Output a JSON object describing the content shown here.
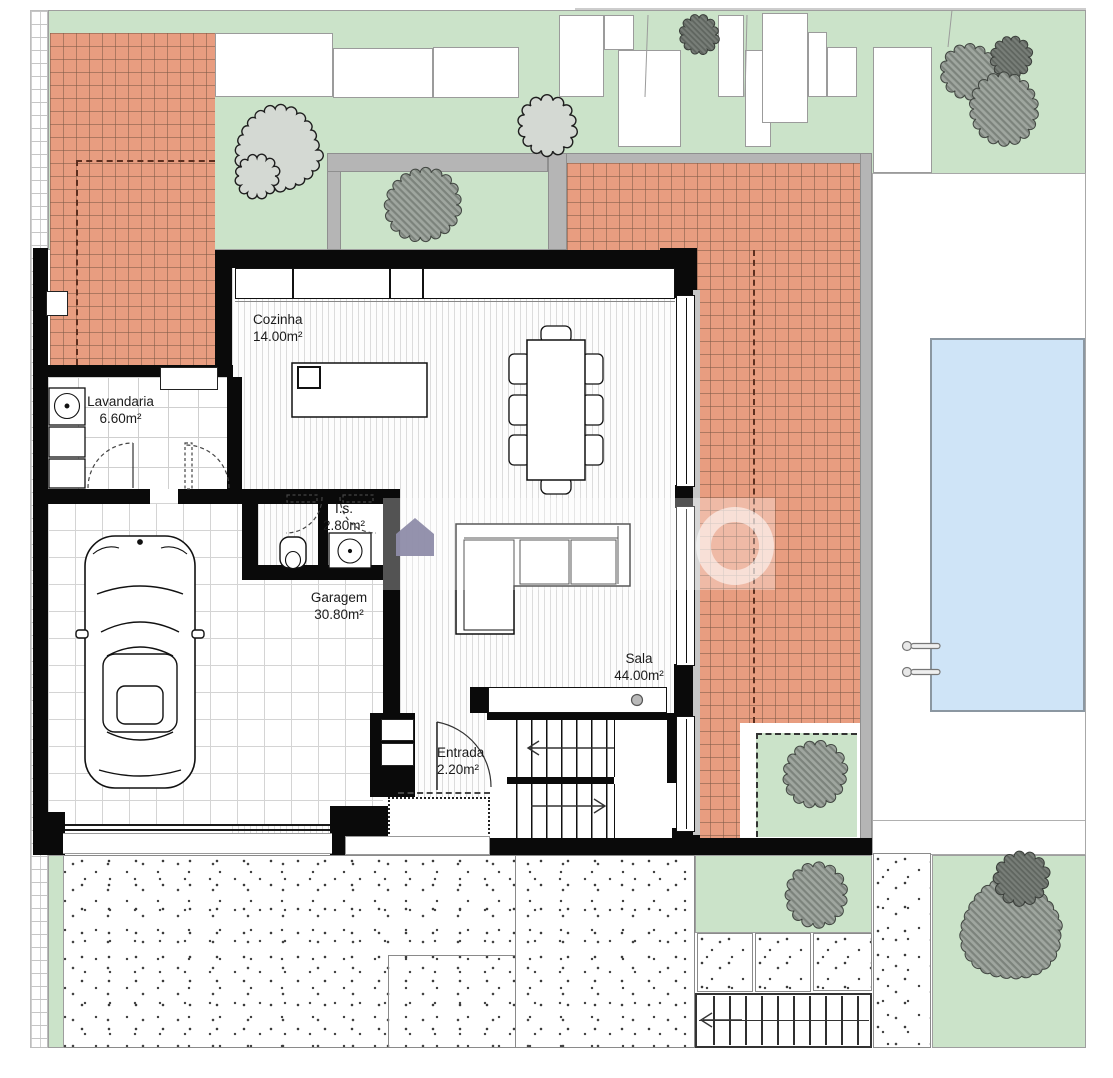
{
  "title": "House ground-floor plan with garden and pool",
  "rooms": {
    "cozinha": {
      "label": "Cozinha",
      "area": "14.00m²"
    },
    "lavandaria": {
      "label": "Lavandaria",
      "area": "6.60m²"
    },
    "is": {
      "label": "I.s.",
      "area": "2.80m²"
    },
    "garagem": {
      "label": "Garagem",
      "area": "30.80m²"
    },
    "sala": {
      "label": "Sala",
      "area": "44.00m²"
    },
    "entrada": {
      "label": "Entrada",
      "area": "2.20m²"
    }
  },
  "colors": {
    "grass": "#cbe3c9",
    "patio_tile": "#e89d80",
    "path_gray": "#b5b5b5",
    "pool_water": "#cfe4f7",
    "wall": "#0a0a0a",
    "watermark": "#8e8ca9"
  },
  "features": {
    "pool": "swimming pool with ladder",
    "car": "car parked in garage",
    "dining_seats": 8,
    "stair_arrows": {
      "upper": "left",
      "lower": "right",
      "exterior_walkway": "left"
    },
    "watermark": "house-logo watermark with translucent ring"
  },
  "site": {
    "trees": [
      {
        "x": 278,
        "y": 150,
        "r": 41,
        "v": "light"
      },
      {
        "x": 257,
        "y": 176,
        "r": 19,
        "v": "light"
      },
      {
        "x": 423,
        "y": 205,
        "r": 34,
        "v": "hatch"
      },
      {
        "x": 547,
        "y": 126,
        "r": 26,
        "v": "light"
      },
      {
        "x": 699,
        "y": 35,
        "r": 17,
        "v": "solid"
      },
      {
        "x": 970,
        "y": 72,
        "r": 25,
        "v": "hatch"
      },
      {
        "x": 1011,
        "y": 57,
        "r": 18,
        "v": "solid"
      },
      {
        "x": 1004,
        "y": 109,
        "r": 32,
        "v": "hatch"
      },
      {
        "x": 815,
        "y": 774,
        "r": 29,
        "v": "hatch"
      },
      {
        "x": 816,
        "y": 895,
        "r": 28,
        "v": "hatch"
      },
      {
        "x": 1011,
        "y": 930,
        "r": 50,
        "v": "hatch"
      },
      {
        "x": 1022,
        "y": 878,
        "r": 24,
        "v": "solid"
      }
    ],
    "parcels": [
      [
        215,
        33,
        118,
        64
      ],
      [
        333,
        48,
        100,
        50
      ],
      [
        433,
        47,
        86,
        51
      ],
      [
        559,
        15,
        45,
        82
      ],
      [
        604,
        15,
        30,
        35
      ],
      [
        618,
        50,
        63,
        97
      ],
      [
        718,
        15,
        26,
        82
      ],
      [
        745,
        50,
        26,
        97
      ],
      [
        762,
        13,
        46,
        110
      ],
      [
        808,
        32,
        19,
        65
      ],
      [
        827,
        47,
        30,
        50
      ],
      [
        873,
        47,
        59,
        126
      ]
    ]
  }
}
